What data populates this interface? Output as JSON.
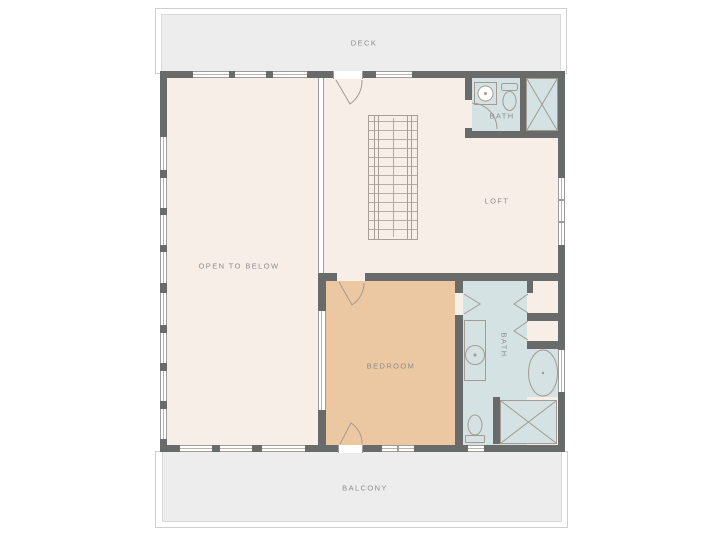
{
  "plan": {
    "labels": {
      "deck": "DECK",
      "balcony": "BALCONY",
      "open_to_below": "OPEN TO BELOW",
      "loft": "LOFT",
      "bath_upper": "BATH",
      "bath_lower": "BATH",
      "bedroom": "BEDROOM"
    },
    "colors": {
      "wall": "#696a6a",
      "floor": "#f7eee8",
      "bedroom_floor": "#ebc8a2",
      "bath_floor": "#d4e2e4",
      "outdoor": "#ededed",
      "label_text": "#8c8c8c",
      "line": "#a39a91"
    },
    "fixtures": [
      "staircase",
      "railing",
      "bathtub",
      "shower",
      "toilet",
      "sink-vanity",
      "closet",
      "door-swing",
      "window"
    ]
  }
}
